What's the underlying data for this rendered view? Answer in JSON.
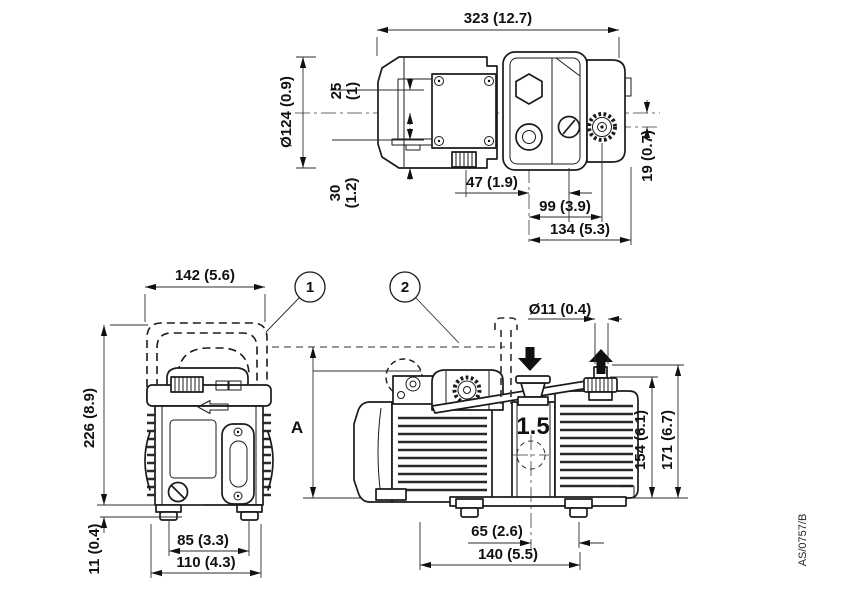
{
  "drawing": {
    "reference": "AS/0757/B",
    "callouts": {
      "c1": "1",
      "c2": "2"
    },
    "top_view": {
      "dims": {
        "overall_length": "323 (12.7)",
        "offset_upper": {
          "mm": "25",
          "in": "(1)"
        },
        "motor_diameter": "Ø124 (0.9)",
        "offset_lower": {
          "mm": "30",
          "in": "(1.2)"
        },
        "inlet_offset": "47 (1.9)",
        "port_span": "99 (3.9)",
        "module_length": "134 (5.3)",
        "gas_ballast_offset": "19 (0.7)"
      }
    },
    "front_view": {
      "dims": {
        "handle_width": "142 (5.6)",
        "overall_height": "226 (8.9)",
        "foot_span": "85 (3.3)",
        "base_width": "110 (4.3)",
        "foot_height": "11 (0.4)"
      }
    },
    "side_view": {
      "model_label": "1.5",
      "dims": {
        "port_diameter": "Ø11 (0.4)",
        "handle_height": "A",
        "body_height": "154 (6.1)",
        "overall_height": "171 (6.7)",
        "inlet_offset": "65 (2.6)",
        "foot_span": "140 (5.5)"
      }
    }
  }
}
